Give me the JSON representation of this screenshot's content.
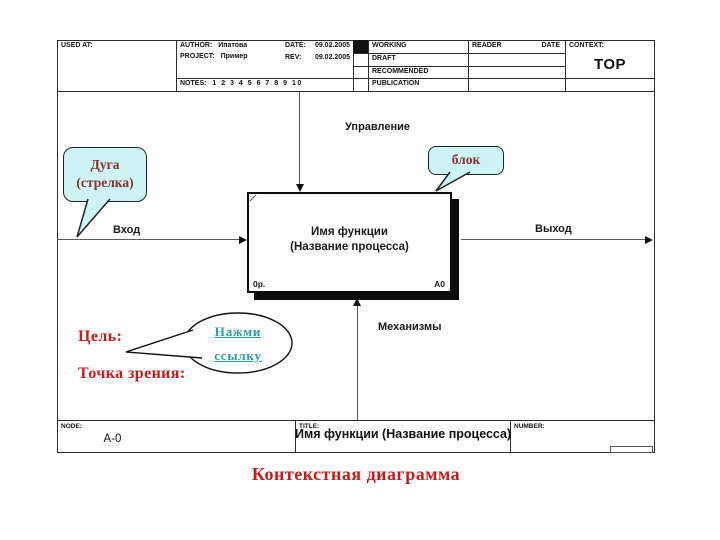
{
  "header": {
    "used_at": "USED AT:",
    "author_label": "AUTHOR:",
    "author": "Ипатова",
    "project_label": "PROJECT:",
    "project": "Пример",
    "date_label": "DATE:",
    "date": "09.02.2005",
    "rev_label": "REV:",
    "rev": "09.02.2005",
    "notes_label": "NOTES:",
    "notes": "1 2 3 4 5 6 7 8 9 10",
    "status_rows": [
      "WORKING",
      "DRAFT",
      "RECOMMENDED",
      "PUBLICATION"
    ],
    "reader": "READER",
    "date_col": "DATE",
    "context_label": "CONTEXT:",
    "context_value": "TOP"
  },
  "diagram": {
    "control": "Управление",
    "input": "Вход",
    "output": "Выход",
    "mechanism": "Механизмы",
    "block_line1": "Имя функции",
    "block_line2": "(Название процесса)",
    "block_cost": "0р.",
    "block_node": "A0"
  },
  "footer": {
    "node_label": "NODE:",
    "node": "A-0",
    "title_label": "TITLE:",
    "title": "Имя функции (Название процесса)",
    "number_label": "NUMBER:"
  },
  "annotations": {
    "arc_line1": "Дуга",
    "arc_line2": "(стрелка)",
    "block_callout": "блок",
    "goal": "Цель:",
    "viewpoint": "Точка зрения:",
    "link_line1": "Нажми",
    "link_line2": "ссылку",
    "caption": "Контекстная диаграмма"
  },
  "colors": {
    "bubble_fill": "#cdf4f4",
    "callout_text": "#8b2e2e",
    "red_text": "#cc1a1a",
    "link_text": "#2a9e9e"
  }
}
